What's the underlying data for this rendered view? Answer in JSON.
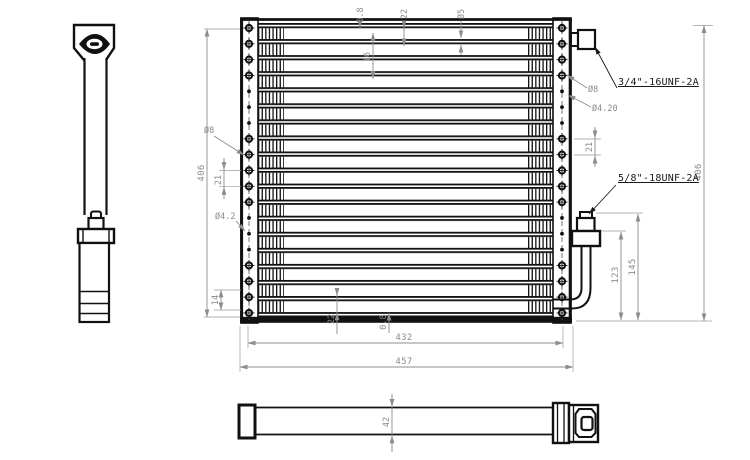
{
  "callouts": {
    "top_port": "3/4\"-16UNF-2A",
    "bottom_port": "5/8\"-18UNF-2A"
  },
  "dimensions": {
    "height_left": "406",
    "height_right": "406",
    "core_width": "432",
    "overall_width": "457",
    "tube_wall_top": "0.8",
    "tube_pitch_top": "22",
    "tube_dia": "Ø5",
    "fin_height": "16",
    "hole_dia_left": "Ø8",
    "hole_pitch_left": "21",
    "hole_small_left": "Ø4.2",
    "bottom_offset": "14",
    "tube_pitch_bottom": "22",
    "tube_wall_bottom": "0.8",
    "hole_dia_right": "Ø8",
    "hole_small_right": "Ø4.20",
    "hole_pitch_right": "21",
    "pipe_length_inner": "123",
    "pipe_length_outer": "145",
    "depth": "42"
  },
  "front_view": {
    "left_plate_holes": {
      "x": 249,
      "start_y": 28,
      "pitch": 15.83,
      "pattern": [
        "big",
        "big",
        "big",
        "big",
        "small",
        "small",
        "small",
        "big",
        "big",
        "big",
        "big",
        "big",
        "small",
        "small",
        "small",
        "big",
        "big",
        "big",
        "big"
      ]
    },
    "right_plate_holes": {
      "x": 562,
      "start_y": 28,
      "pitch": 15.83,
      "pattern": [
        "big",
        "big",
        "big",
        "big",
        "small",
        "small",
        "small",
        "big",
        "big",
        "big",
        "big",
        "big",
        "small",
        "small",
        "small",
        "big",
        "big",
        "big",
        "big"
      ]
    }
  }
}
